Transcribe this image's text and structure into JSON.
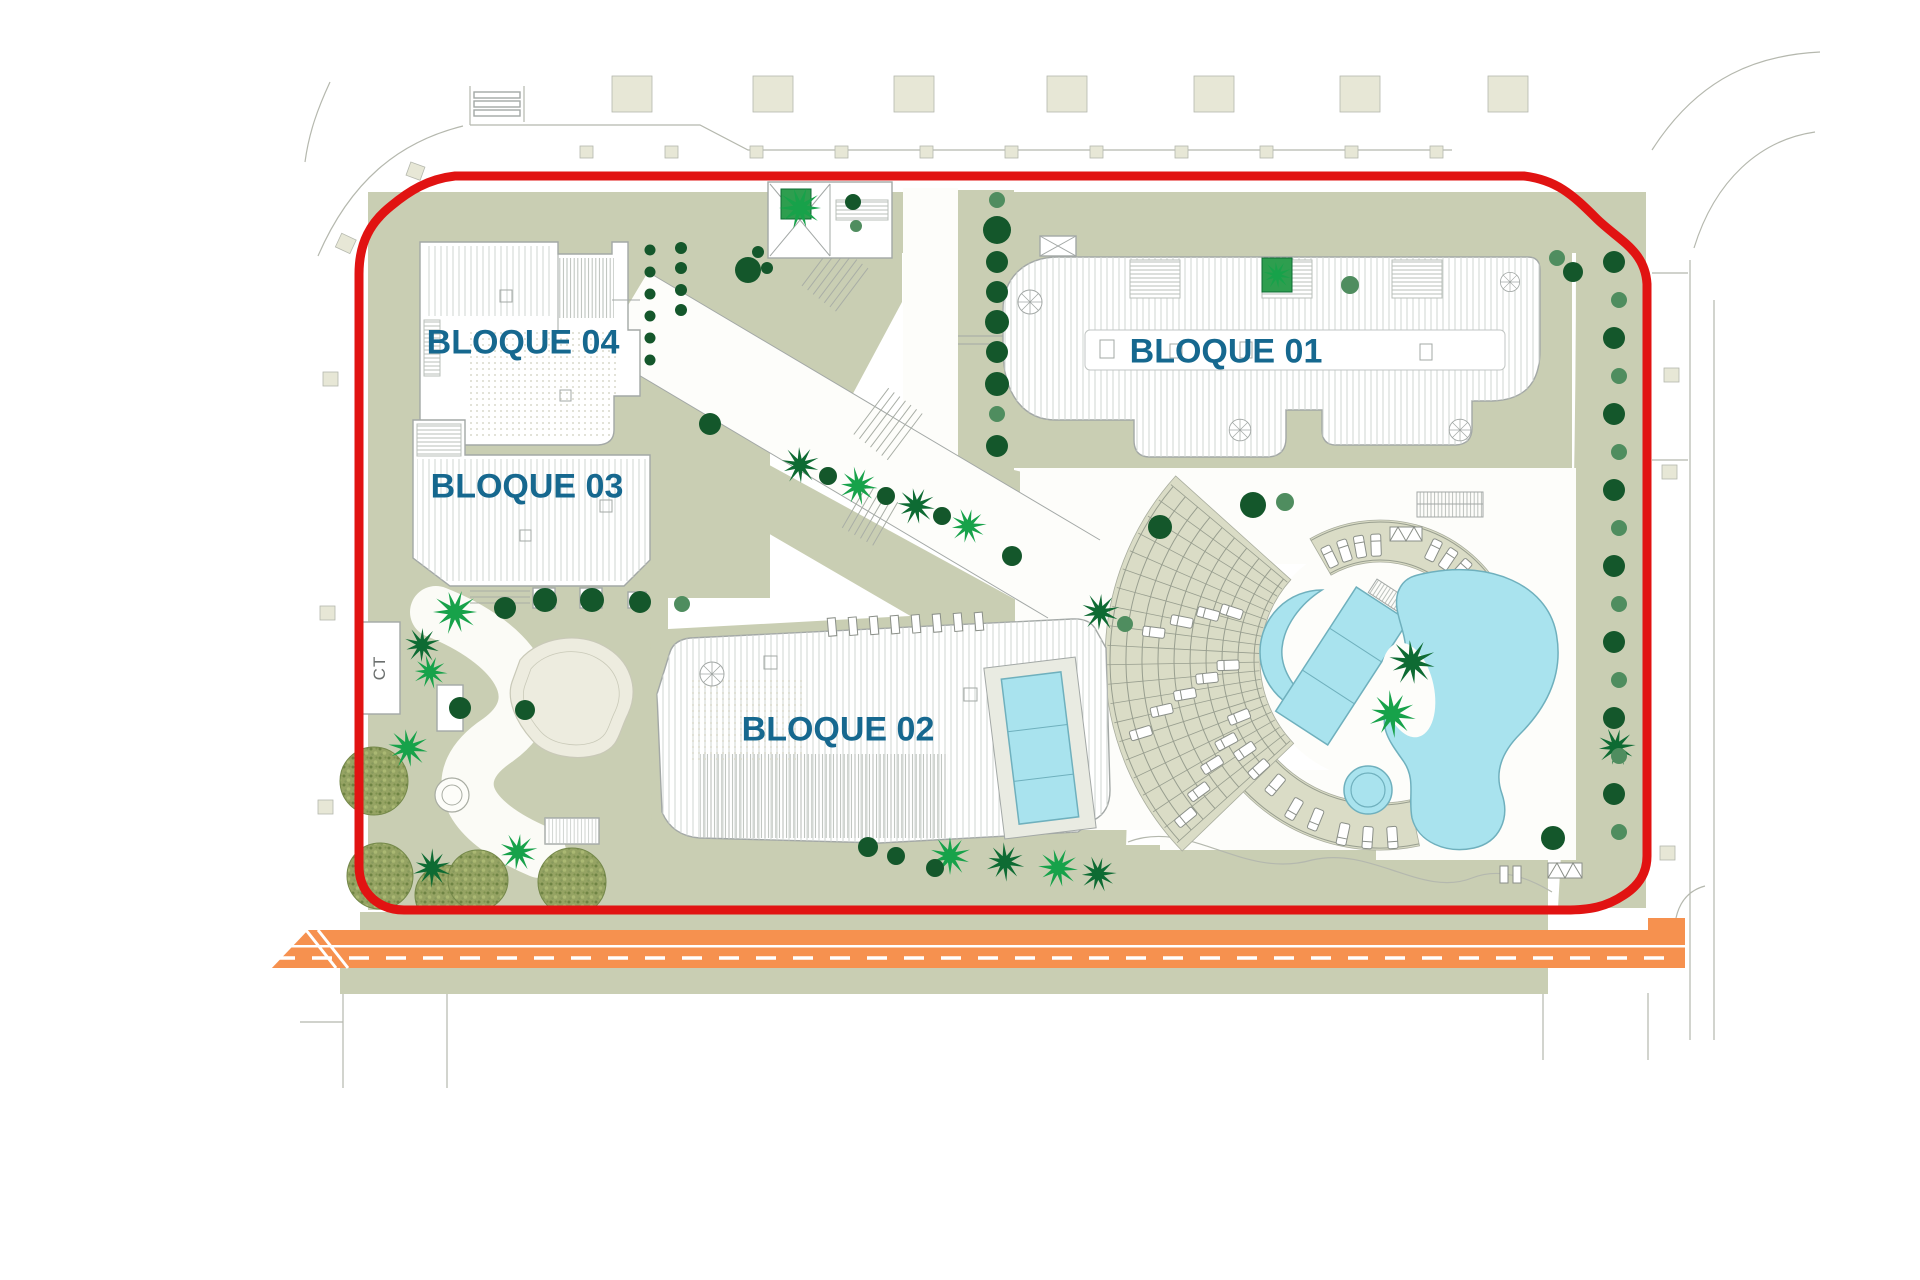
{
  "labels": {
    "block01": "BLOQUE 01",
    "block02": "BLOQUE 02",
    "block03": "BLOQUE 03",
    "block04": "BLOQUE 04",
    "ct": "CT"
  },
  "palette": {
    "red": "#e11312",
    "label": "#16688f",
    "sage": "#c9ceb3",
    "beige": "#dadcc6",
    "pool": "#a9e3ee",
    "pooledge": "#6fb0bd",
    "road": "#f6914f",
    "treed": "#14572b",
    "treem": "#4f8d5f",
    "palmb": "#17a24a",
    "palmd": "#0e6b33",
    "line": "#b5b8ae",
    "bldline": "#a3a8a6",
    "pav": "#e7e7d6"
  }
}
